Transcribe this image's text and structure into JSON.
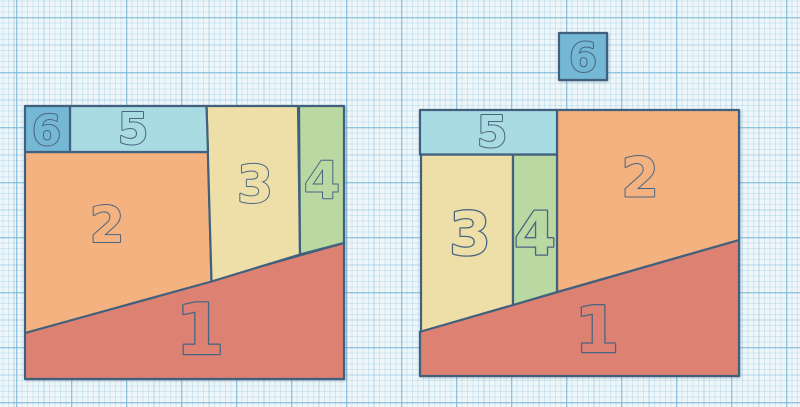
{
  "app": {
    "name": "geometry-puzzle-canvas",
    "description": "Two arrangements of the same six numbered polygon pieces on graph paper; left square uses pieces 1-6, right square uses pieces 1-5 with piece 6 left outside"
  },
  "palette": {
    "background": "#eff6f9",
    "grid_fine": "#9eccе5",
    "grid_medium": "#86c1de",
    "grid_strong": "#76b6d6",
    "outline": "#41607d",
    "glyph_outline": "#4a6580",
    "piece_colors": {
      "1": "#dd8173",
      "2": "#f3b280",
      "3": "#eedfa9",
      "4": "#b9d8a2",
      "5": "#a9dbe2",
      "6": "#74b8d6"
    }
  },
  "stroke_width": 2.2,
  "figures": [
    {
      "id": "left-arrangement",
      "description": "assembled square containing all pieces 1 through 6",
      "pieces": [
        {
          "label": "1",
          "points": [
            [
              25,
              333
            ],
            [
              344,
              243
            ],
            [
              344,
              379
            ],
            [
              25,
              379
            ]
          ],
          "label_x": 200,
          "label_y": 329,
          "font_size": 70
        },
        {
          "label": "2",
          "points": [
            [
              25,
              152
            ],
            [
              208,
              152
            ],
            [
              211.5,
              281.5
            ],
            [
              25,
              333
            ]
          ],
          "label_x": 107,
          "label_y": 224,
          "font_size": 50
        },
        {
          "label": "3",
          "points": [
            [
              206.5,
              106
            ],
            [
              298,
              106
            ],
            [
              300,
              254.5
            ],
            [
              211.5,
              281.5
            ]
          ],
          "label_x": 255,
          "label_y": 184,
          "font_size": 52
        },
        {
          "label": "4",
          "points": [
            [
              299,
              106
            ],
            [
              344,
              106
            ],
            [
              344,
              243
            ],
            [
              300,
              254.5
            ]
          ],
          "label_x": 322,
          "label_y": 180,
          "font_size": 52
        },
        {
          "label": "5",
          "points": [
            [
              70,
              106
            ],
            [
              206.5,
              106
            ],
            [
              208,
              152
            ],
            [
              70,
              152
            ]
          ],
          "label_x": 133,
          "label_y": 128,
          "font_size": 44
        },
        {
          "label": "6",
          "points": [
            [
              25,
              106
            ],
            [
              70,
              106
            ],
            [
              70,
              152
            ],
            [
              25,
              152
            ]
          ],
          "label_x": 46.5,
          "label_y": 130,
          "font_size": 42
        }
      ]
    },
    {
      "id": "right-arrangement",
      "description": "assembled square containing pieces 1 through 5, with piece 6 placed outside above",
      "pieces": [
        {
          "label": "1",
          "points": [
            [
              420,
              331.5
            ],
            [
              739,
              240
            ],
            [
              739,
              376
            ],
            [
              420,
              376
            ]
          ],
          "label_x": 597,
          "label_y": 329,
          "font_size": 64
        },
        {
          "label": "2",
          "points": [
            [
              557,
              110
            ],
            [
              739,
              110
            ],
            [
              739,
              240
            ],
            [
              557,
              292
            ]
          ],
          "label_x": 640,
          "label_y": 177,
          "font_size": 54
        },
        {
          "label": "3",
          "points": [
            [
              421,
              154.5
            ],
            [
              513,
              154.5
            ],
            [
              513,
              305
            ],
            [
              421,
              331.5
            ]
          ],
          "label_x": 470,
          "label_y": 233,
          "font_size": 60
        },
        {
          "label": "4",
          "points": [
            [
              513,
              154.5
            ],
            [
              557,
              154.5
            ],
            [
              557,
              292
            ],
            [
              513,
              305
            ]
          ],
          "label_x": 535,
          "label_y": 233,
          "font_size": 60
        },
        {
          "label": "5",
          "points": [
            [
              420,
              110
            ],
            [
              557,
              110
            ],
            [
              557,
              154.5
            ],
            [
              420,
              154.5
            ]
          ],
          "label_x": 492,
          "label_y": 131,
          "font_size": 44
        },
        {
          "label": "6",
          "points": [
            [
              559,
              33
            ],
            [
              607,
              33
            ],
            [
              607,
              80
            ],
            [
              559,
              80
            ]
          ],
          "label_x": 583,
          "label_y": 57,
          "font_size": 40
        }
      ]
    }
  ]
}
